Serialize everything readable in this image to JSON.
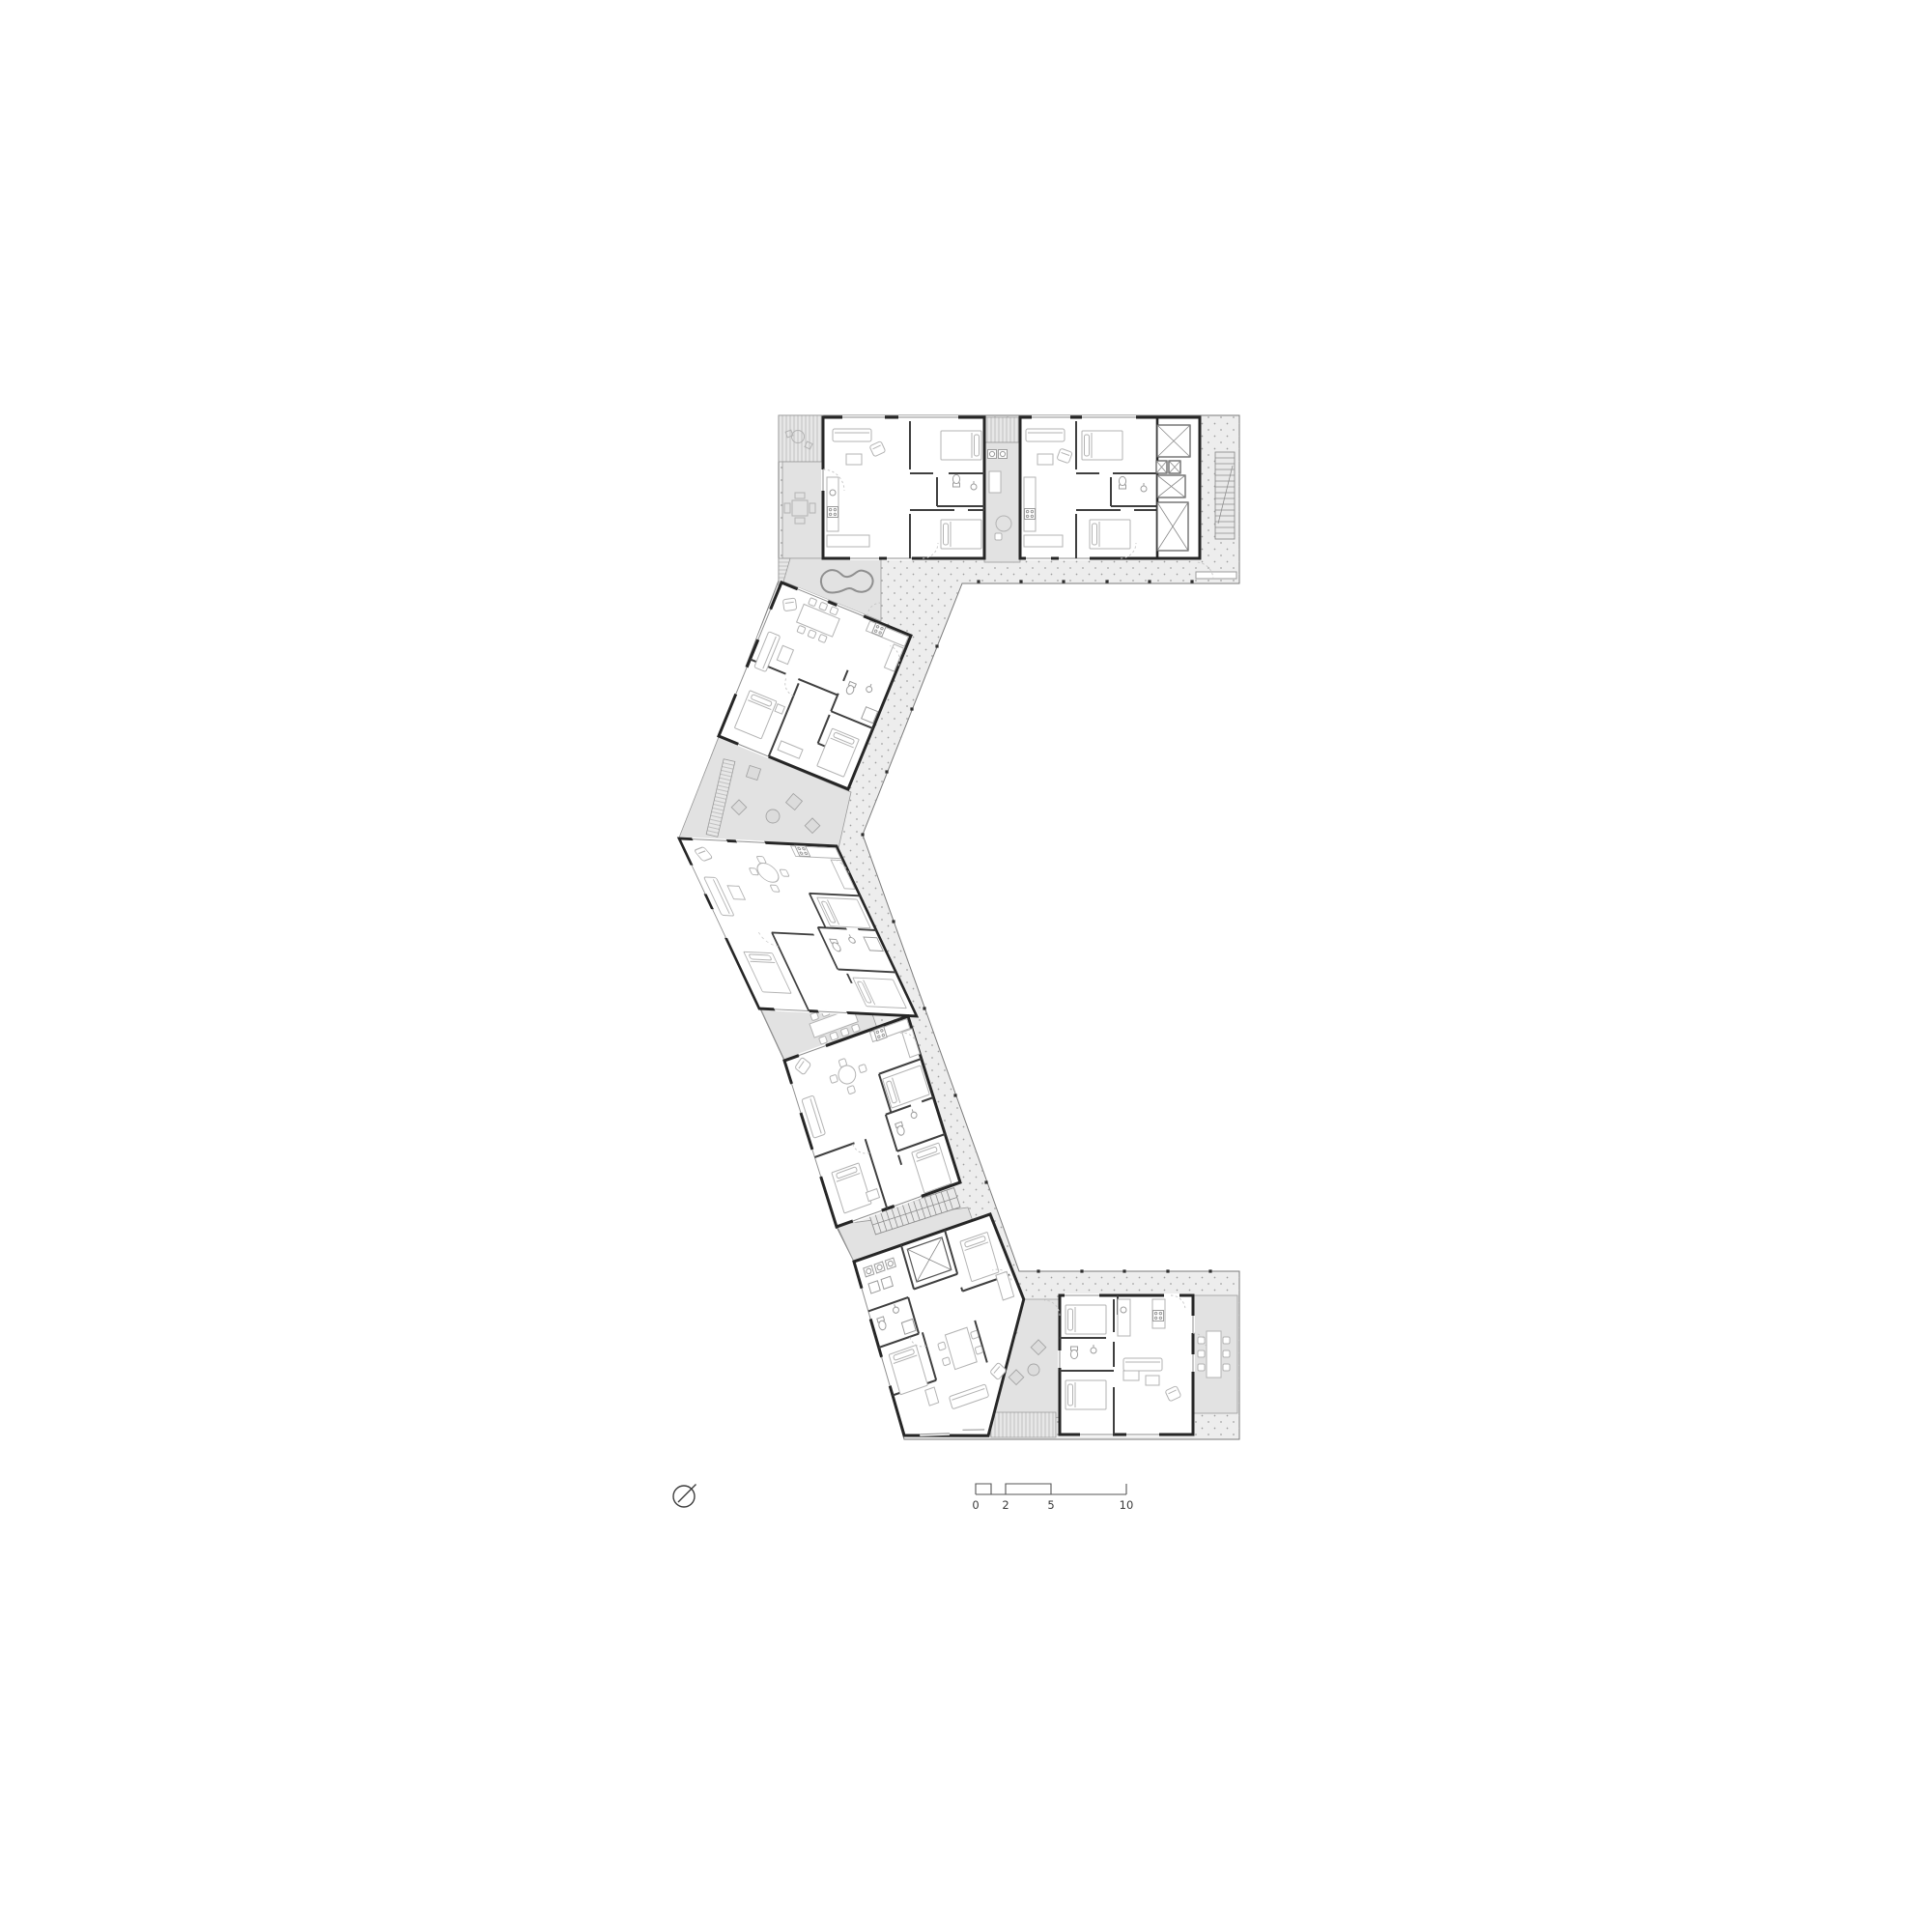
{
  "drawing": {
    "kind": "residential floor plan",
    "scale_bar": {
      "labels": [
        "0",
        "2",
        "5",
        "10"
      ]
    },
    "north_arrow_present": true
  },
  "colors": {
    "paper": "#ffffff",
    "wall": "#262626",
    "partition": "#3f3f3f",
    "walkway": "#ededed",
    "patio": "#e2e2e2",
    "hatch-bg": "#e7e7e7",
    "hatch-line": "#b0b0b0",
    "dot": "#9e9e9e",
    "furniture": "#b3b3b3",
    "window-line": "#8f8f8f",
    "door-arc": "#c6c6c6",
    "tread": "#8d8d8d",
    "outline": "#7a7a7a",
    "column": "#2e2e2e",
    "text": "#3a3a3a",
    "pond": "#8f8f8f"
  },
  "icons": {
    "north_arrow": "north-arrow-icon",
    "elevator": "elevator-x-icon",
    "stairs": "stair-treads-icon"
  }
}
